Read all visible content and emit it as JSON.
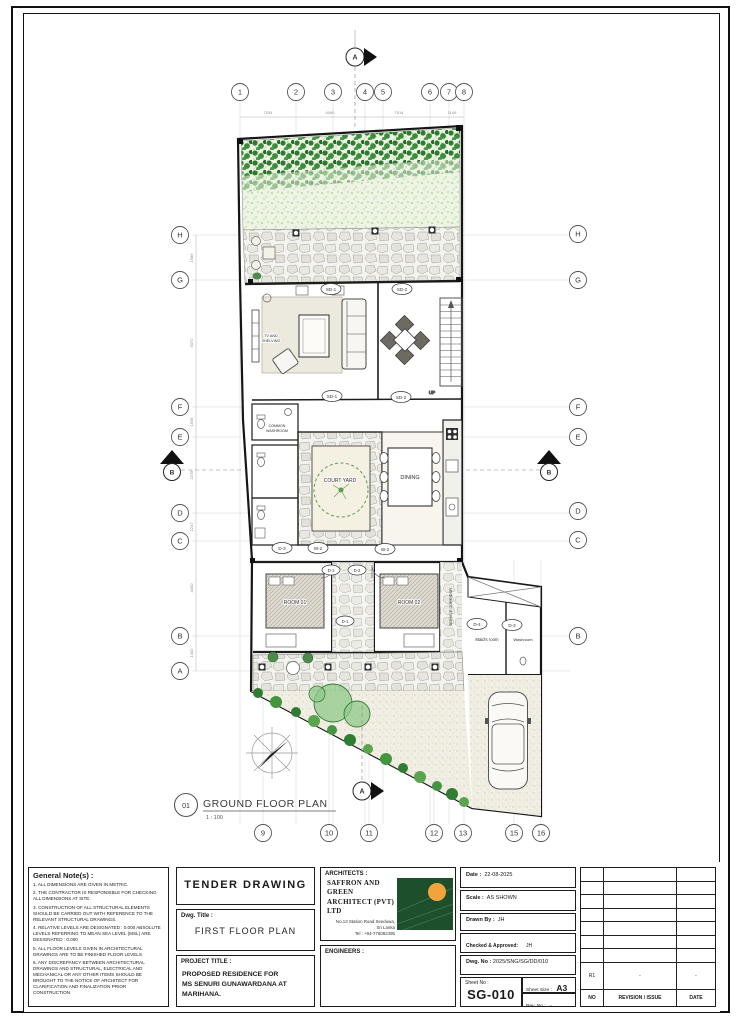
{
  "plan": {
    "callout_no": "01",
    "title": "GROUND FLOOR PLAN",
    "scale": "1 : 100",
    "grid_top": [
      "1",
      "2",
      "3",
      "4",
      "5",
      "6",
      "7",
      "8"
    ],
    "grid_bottom": [
      "9",
      "10",
      "11",
      "12",
      "13",
      "15",
      "16"
    ],
    "grid_left": [
      "H",
      "G",
      "F",
      "E",
      "D",
      "C",
      "B",
      "A"
    ],
    "grid_right": [
      "H",
      "G",
      "F",
      "E",
      "D",
      "C",
      "B"
    ],
    "section_a": "A",
    "section_b": "B",
    "rooms": {
      "tv1": "TV AND",
      "tv2": "SHELVING",
      "common1": "COMMON",
      "common2": "WASHROOM",
      "courtyard": "COURT YARD",
      "dining": "DINING",
      "room1": "ROOM 01",
      "room2": "ROOM 02",
      "service": "SERVICE CORRIDOR",
      "maids": "Maid's room",
      "washroom": "Washroom",
      "up": "UP"
    },
    "tags": {
      "sd1": "SD-1",
      "sd2": "SD-2",
      "d1": "D-1",
      "d2": "D-2",
      "d3": "D-3",
      "d4": "D-4",
      "w2": "W-2"
    },
    "dims_top": [
      "7034",
      "4090",
      "7014",
      "1149"
    ],
    "dims_left": [
      "1986",
      "5072",
      "1558",
      "2278",
      "1247",
      "4400",
      "1402"
    ],
    "dims_right": [
      "5728"
    ]
  },
  "titleblock": {
    "general_notes": {
      "title": "General Note(s) :",
      "items": [
        "1. ALL DIMENSIONS ARE GIVEN IN METRIC.",
        "2. THE CONTRACTOR IS RESPONSIBLE FOR CHECKING ALL DIMENSIONS AT SITE.",
        "3. CONSTRUCTION OF ALL STRUCTURAL ELEMENTS SHOULD BE CARRIED OUT WITH REFERENCE TO THE RELEVANT STRUCTURAL DRAWINGS.",
        "4. RELATIVE LEVELS ARE DESIGNATED : 0.000 ABSOLUTE LEVELS REFERRING TO MEAN SEA LEVEL (MSL) ARE DESIGNATED : 0.000",
        "5. ALL FLOOR LEVELS GIVEN IN ARCHITECTURAL DRAWINGS ARE TO BE FINISHED FLOOR LEVELS.",
        "6. ANY DISCREPANCY BETWEEN ARCHITECTURAL DRAWINGS AND STRUCTURAL, ELECTRICAL AND MECHANICAL OR ANY OTHER ITEMS SHOULD BE BROUGHT TO THE NOTICE OF ARCHITECT FOR CLARIFICATION AND FINALIZATION PRIOR CONSTRUCTION."
      ]
    },
    "tender": "TENDER  DRAWING",
    "dwg_title_label": "Dwg. Title :",
    "dwg_title": "FIRST FLOOR PLAN",
    "project_title_label": "PROJECT TITLE :",
    "project_line1": "PROPOSED RESIDENCE FOR",
    "project_line2": "MS SENURI GUNAWARDANA AT",
    "project_line3": "MARIHANA.",
    "architects": {
      "label": "ARCHITECTS :",
      "name_line1": "SAFFRON AND GREEN",
      "name_line2": "ARCHITECT  (PVT) LTD",
      "address_line1": "No.13 Station Road Seeduwa,",
      "address_line2": "Sri Lanka",
      "tel": "Tel : +94-776082495"
    },
    "engineers_label": "ENGINEERS :",
    "meta": {
      "date_label": "Date :",
      "date": "22-08-2025",
      "scale_label": "Scale :",
      "scale": "AS SHOWN",
      "drawn_label": "Drawn By :",
      "drawn": "JH",
      "checked_label": "Checked & Approved:",
      "checked": "JH",
      "dwgno_label": "Dwg. No :",
      "dwgno": "2025/SNG/SG/DD/010",
      "sheetno_label": "Sheet No :",
      "sheetno": "SG-010",
      "sheetsize_label": "Sheet Size :",
      "sheetsize": "A3",
      "revno_label": "Rev. No :",
      "revno": "-"
    },
    "revision": {
      "r1": "R1",
      "r1_desc": "-",
      "r1_date": "-",
      "no_header": "NO",
      "rev_header": "REVISION / ISSUE",
      "date_header": "DATE"
    }
  }
}
